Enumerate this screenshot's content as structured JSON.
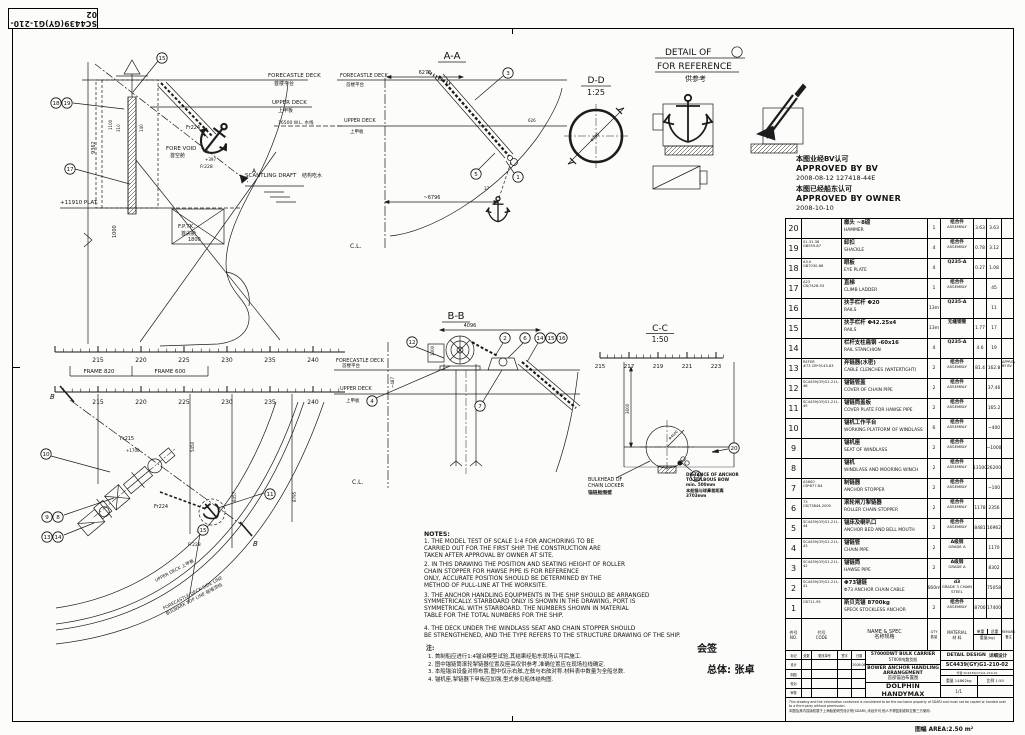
{
  "sheet": {
    "drawing_no_box": "SC4439(GY)G1-210-02",
    "area_note": "图幅 AREA:2.50 m²"
  },
  "approval": {
    "cn1": "本图业经BV认可",
    "en1": "APPROVED BY BV",
    "date1": "2008-08-12   127418-44E",
    "cn2": "本图已经船东认可",
    "en2": "APPROVED BY OWNER",
    "date2": "2008-10-10"
  },
  "views": {
    "profile": {
      "forecastle_deck": "FORECASTLE DECK",
      "forecastle_deck_cn": "首楼平台",
      "upper_deck": "UPPER DECK",
      "upper_deck_cn": "上甲板",
      "waterline": "16500 W.L. 水线",
      "fore_void": "FORE VOID",
      "fore_void_cn": "首空舱",
      "scantling": "SCANTLING DRAFT",
      "scantling_cn": "结构吃水",
      "plat": "+11910 PLAT.",
      "fptk": "F.P.TK.",
      "fptk_cn": "首尖舱",
      "fr224": "Fr224",
      "fr228": "Fr228",
      "fr228_elev": "+397",
      "sec_a": "A",
      "d9362": "9362",
      "d1100": "1100",
      "d310": "310",
      "d140": "140",
      "d1000": "1000",
      "d1800": "1800",
      "frames": [
        "215",
        "220",
        "225",
        "230",
        "235",
        "240"
      ],
      "frame820": "FRAME 820",
      "frame600": "FRAME 600",
      "callouts": {
        "c15": "15",
        "c18": "18",
        "c19": "19",
        "c17": "17"
      }
    },
    "aa": {
      "title": "A-A",
      "forecastle_deck": "FORECASTLE DECK",
      "forecastle_deck_cn": "首楼平台",
      "upper_deck": "UPPER DECK",
      "upper_deck_cn": "上甲板",
      "cl": "C.L.",
      "d6272": "6272",
      "d626": "626",
      "d37": "37",
      "d6796": "~6796",
      "callouts": {
        "c3": "3",
        "c5": "5",
        "c1": "1"
      }
    },
    "dd": {
      "title": "D-D",
      "scale": "1:25",
      "dim": "Φ735"
    },
    "detail1": {
      "title": "DETAIL OF",
      "num": "1",
      "sub": "FOR REFERENCE",
      "sub_cn": "供参考"
    },
    "bb": {
      "title": "B-B",
      "forecastle_deck": "FORECASTLE DECK",
      "forecastle_deck_cn": "首楼平台",
      "upper_deck": "UPPER DECK",
      "upper_deck_cn": "上甲板",
      "cl": "C.L.",
      "d4096": "4096",
      "d1300": "1300",
      "d487": "~487",
      "callouts": {
        "c12": "12",
        "c2": "2",
        "c6": "6",
        "c14": "14",
        "c15": "15",
        "c16": "16",
        "c4": "4",
        "c7": "7"
      }
    },
    "cc": {
      "title": "C-C",
      "scale": "1:50",
      "frames": [
        "215",
        "217",
        "219",
        "221",
        "223"
      ],
      "d3600": "3600",
      "dphi": "Φ4600",
      "bulkhead1": "BULKHEAD OF",
      "bulkhead2": "CHAIN LOCKER",
      "bulkhead_cn": "锚链舱围壁",
      "callouts": {
        "c13": "13",
        "c20": "20"
      }
    },
    "plan": {
      "frames": [
        "215",
        "220",
        "225",
        "230",
        "235",
        "240"
      ],
      "fr215": "Fr215",
      "fr224": "Fr224",
      "fr228": "Fr228",
      "e1700": "+1700",
      "e397": "+397",
      "d5450": "5450",
      "d8457": "8457",
      "d8795": "8795",
      "b": "B",
      "upper_deck_line": "UPPER DECK 上甲板",
      "fcsl_line": "FORECASTLE DECK SIDE LINE",
      "bulwark_line": "BULWARK TOP LINE 舷墙顶线",
      "callouts": {
        "c10": "10",
        "c11": "11",
        "c9": "9",
        "c8": "8",
        "c13": "13",
        "c14": "14",
        "c15": "15"
      }
    },
    "dist_note": {
      "l1": "DISTANCE OF ANCHOR",
      "l2": "TO BULBOUS BOW",
      "l3": "min. 500mm",
      "l4": "本船锚与球鼻首距离",
      "l5": "3703mm"
    }
  },
  "notes": {
    "heading": "NOTES:",
    "en": [
      "1. THE MODEL TEST OF SCALE 1:4 FOR ANCHORING TO BE\nCARRIED OUT FOR THE FIRST SHIP. THE CONSTRUCTION ARE\nTAKEN AFTER APPROVAL BY OWNER AT SITE.",
      "2. IN THIS DRAWING THE POSITION AND SEATING HEIGHT OF ROLLER\nCHAIN STOPPER FOR HAWSE PIPE IS FOR REFERENCE\nONLY, ACCURATE POSITION SHOULD BE DETERMINED BY THE\nMETHOD OF PULL-LINE AT THE WORKSITE.",
      "3. THE ANCHOR HANDLING EQUIPMENTS IN THE SHIP SHOULD BE ARRANGED\nSYMMETRICALLY. STARBOARD ONLY IS SHOWN IN THE DRAWING, PORT IS\nSYMMETRICAL WITH STARBOARD. THE NUMBERS SHOWN IN MATERIAL\nTABLE FOR THE TOTAL NUMBERS FOR THE SHIP.",
      "4. THE DECK UNDER THE WINDLASS SEAT AND CHAIN STOPPER SHOULD\nBE STRENGTHENED, AND THE TYPE REFERS TO THE STRUCTURE DRAWING OF THE SHIP."
    ],
    "heading_cn": "注:",
    "cn": [
      "1. 首制船应进行1:4锚泊模型试验,其结果经船东现场认可后施工.",
      "2. 图中锚链筒滚轮掣链器位置及座高仅供参考,准确位置应在现场拉线确定.",
      "3. 本船锚泊设备对称布置,图中仅示右舷,左舷与右舷对称.材料表中数量为全船总数.",
      "4. 锚机座,掣链器下甲板应加强,型式参见船体结构图."
    ]
  },
  "signoff": {
    "l1": "会签",
    "l2": "总体: 张卓"
  },
  "bom": {
    "header": {
      "no_cn": "件号",
      "no_en": "NO.",
      "code_cn": "代号",
      "code_en": "CODE",
      "name_en": "NAME & SPEC",
      "name_cn": "名称规格",
      "qty_en": "QTY",
      "qty_cn": "数量",
      "mat_en": "MATERIAL",
      "mat_cn": "材 料",
      "uw": "单重",
      "tw": "总重",
      "wt": "重量(kg)",
      "rm_en": "REMARK",
      "rm_cn": "备注"
    },
    "rows": [
      {
        "no": "20",
        "code": "",
        "name_cn": "榔头  ~8磅",
        "name_en": "HAMMER",
        "qty": "1",
        "mat_cn": "组合件",
        "mat_en": "ASSEMBLY",
        "uw": "3.63",
        "tw": "3.63",
        "rm": ""
      },
      {
        "no": "19",
        "code": "01-31.36\nGB559-87",
        "name_cn": "卸扣",
        "name_en": "SHACKLE",
        "qty": "4",
        "mat_cn": "组合件",
        "mat_en": "ASSEMBLY",
        "uw": "0.78",
        "tw": "3.12",
        "rm": ""
      },
      {
        "no": "18",
        "code": "A3.0\nGB7030-86",
        "name_cn": "眼板",
        "name_en": "EYE PLATE",
        "qty": "4",
        "mat_cn": "Q235-A",
        "mat_en": "",
        "uw": "0.27",
        "tw": "1.08",
        "rm": ""
      },
      {
        "no": "17",
        "code": "A23\nCB/T428-93",
        "name_cn": "直梯",
        "name_en": "CLIMB LADDER",
        "qty": "1",
        "mat_cn": "组合件",
        "mat_en": "ASSEMBLY",
        "uw": "",
        "tw": "45",
        "rm": ""
      },
      {
        "no": "16",
        "code": "",
        "name_cn": "扶手栏杆  Φ20",
        "name_en": "RAILS",
        "qty": "13m",
        "mat_cn": "Q235-A",
        "mat_en": "",
        "uw": "",
        "tw": "11",
        "rm": ""
      },
      {
        "no": "15",
        "code": "",
        "name_cn": "扶手栏杆  Φ42.25x4",
        "name_en": "RAILS",
        "qty": "13m",
        "mat_cn": "无缝钢管",
        "mat_en": "",
        "uw": "1.77",
        "tw": "17",
        "rm": ""
      },
      {
        "no": "14",
        "code": "",
        "name_cn": "栏杆支柱扁钢  -60x16",
        "name_en": "RAIL STANCHION",
        "qty": "4",
        "mat_cn": "Q235-A",
        "mat_en": "",
        "uw": "4.6",
        "tw": "19",
        "rm": ""
      },
      {
        "no": "13",
        "code": "REFER\n#73 CB*3143-83",
        "name_cn": "弃链器(水密)",
        "name_en": "CABLE CLENCHES (WATERTIGHT)",
        "qty": "2",
        "mat_cn": "组合件",
        "mat_en": "ASSEMBLY",
        "uw": "81.4",
        "tw": "162.8",
        "rm": "APPROVED\nBY BV"
      },
      {
        "no": "12",
        "code": "SC4439(GY)G1-211-46",
        "name_cn": "锚链管盖",
        "name_en": "COVER OF CHAIN  PIPE",
        "qty": "2",
        "mat_cn": "组合件",
        "mat_en": "ASSEMBLY",
        "uw": "",
        "tw": "37.46",
        "rm": ""
      },
      {
        "no": "11",
        "code": "SC4439(GY)G1-211-45",
        "name_cn": "锚链筒盖板",
        "name_en": "COVER PLATE FOR HAWSE PIPE",
        "qty": "2",
        "mat_cn": "组合件",
        "mat_en": "ASSEMBLY",
        "uw": "",
        "tw": "165.2",
        "rm": ""
      },
      {
        "no": "10",
        "code": "",
        "name_cn": "锚机工作平台",
        "name_en": "WORKING PLATFORM OF WINDLASS",
        "qty": "6",
        "mat_cn": "组合件",
        "mat_en": "ASSEMBLY",
        "uw": "",
        "tw": "~400",
        "rm": ""
      },
      {
        "no": "9",
        "code": "",
        "name_cn": "锚机座",
        "name_en": "SEAT OF WINDLASS",
        "qty": "2",
        "mat_cn": "组合件",
        "mat_en": "ASSEMBLY",
        "uw": "",
        "tw": "~1000",
        "rm": ""
      },
      {
        "no": "8",
        "code": "",
        "name_cn": "锚机",
        "name_en": "WINDLASS AND MOORING WINCH",
        "qty": "2",
        "mat_cn": "组合件",
        "mat_en": "ASSEMBLY",
        "uw": "13100",
        "tw": "26200",
        "rm": ""
      },
      {
        "no": "7",
        "code": "A5600\nCB*877-84",
        "name_cn": "制链器",
        "name_en": "ANCHOR  STOPPER",
        "qty": "2",
        "mat_cn": "组合件",
        "mat_en": "ASSEMBLY",
        "uw": "",
        "tw": "~100",
        "rm": ""
      },
      {
        "no": "6",
        "code": "73\nCB/T3844-2000",
        "name_cn": "滚轮闸刀掣链器",
        "name_en": "ROLLER CHAIN STOPPER",
        "qty": "2",
        "mat_cn": "组合件",
        "mat_en": "ASSEMBLY",
        "uw": "1178",
        "tw": "2356",
        "rm": ""
      },
      {
        "no": "5",
        "code": "SC4439(GY)G1-211-44",
        "name_cn": "锚床及喇叭口",
        "name_en": "ANCHOR BED AND BELL MOUTH",
        "qty": "2",
        "mat_cn": "组合件",
        "mat_en": "ASSEMBLY",
        "uw": "8481",
        "tw": "16962",
        "rm": ""
      },
      {
        "no": "4",
        "code": "SC4439(GY)G1-211-43",
        "name_cn": "锚链管",
        "name_en": "CHAIN PIPE",
        "qty": "2",
        "mat_cn": "A级钢",
        "mat_en": "GRADE A",
        "uw": "",
        "tw": "1170",
        "rm": ""
      },
      {
        "no": "3",
        "code": "SC4439(GY)G1-211-42",
        "name_cn": "锚链筒",
        "name_en": "HAWSE PIPE",
        "qty": "2",
        "mat_cn": "A级钢",
        "mat_en": "GRADE A",
        "uw": "",
        "tw": "8302",
        "rm": ""
      },
      {
        "no": "2",
        "code": "SC4439(GY)G1-211-41",
        "name_cn": "Φ73锚链",
        "name_en": "Φ73 ANCHOR CHAIN CABLE",
        "qty": "660m",
        "mat_cn": "d3",
        "mat_en": "GRADE 3 CHAIN STEEL",
        "uw": "",
        "tw": "75058",
        "rm": ""
      },
      {
        "no": "1",
        "code": "CB711-95",
        "name_cn": "斯贝克锚  8700kg",
        "name_en": "SPECK STOCKLESS ANCHOR",
        "qty": "2",
        "mat_cn": "组合件",
        "mat_en": "ASSEMBLY",
        "uw": "8700",
        "tw": "17400",
        "rm": ""
      }
    ]
  },
  "titleblock": {
    "ship": "57000DWT BULK CARRIER",
    "ship_cn": "57000吨散货船",
    "stage": "DETAIL DESIGN",
    "stage_cn": "详细设计",
    "dwg_no": "SC4439(GY)G1-210-02",
    "replace_note": "代替 SC4439(GY)G1-210-01",
    "title1": "BOWER ANCHOR HANDLING",
    "title2": "ARRANGEMENT",
    "title_cn": "首部锚泊布置图",
    "class_name": "DOLPHIN HANDYMAX",
    "weight_label": "重量",
    "weight": "14862kg",
    "scale_label": "比例",
    "scale": "1:50",
    "sheet_count": "1/1",
    "rev_headers": [
      "标记",
      "处数",
      "更改单号",
      "签字",
      "日期"
    ],
    "sign_labels": [
      "设计",
      "制图",
      "校对",
      "审核"
    ],
    "date": "2008.06",
    "disclaim_en": "This drawing and the information contained is considered to be the exclusive property of SDARI and must not be copied or handed over to a third party without permission.",
    "disclaim_cn": "本图及其内容版权属于上海船舶研究设计院(SDARI),未经许可,他人不得复制或转交第三方使用."
  }
}
